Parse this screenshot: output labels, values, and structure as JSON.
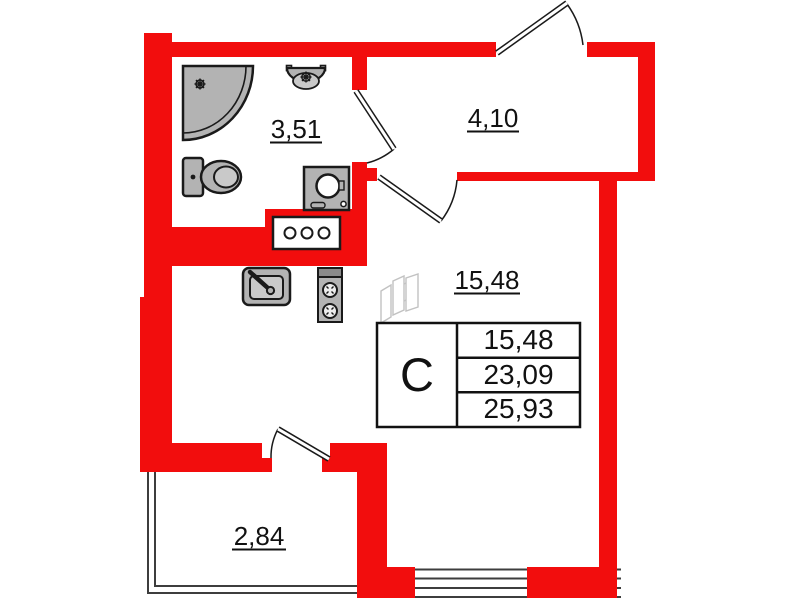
{
  "plan_labels": {
    "bathroom_area": "3,51",
    "hallway_area": "4,10",
    "living_room_area": "15,48",
    "balcony_area": "2,84"
  },
  "summary_table": {
    "unit_type": "С",
    "rows": [
      "15,48",
      "23,09",
      "25,93"
    ]
  },
  "colors": {
    "wall": "#f20d0d",
    "fixture_fill": "#b3b3b3",
    "outline": "#1a1a1a",
    "glazing_line": "#3d3d3d"
  },
  "icons": {
    "shower": "shower-icon",
    "washbasin": "washbasin-icon",
    "toilet": "toilet-icon",
    "washing_machine": "washing-machine-icon",
    "vent_shaft": "vent-shaft-icon",
    "kitchen_sink": "kitchen-sink-icon",
    "stove": "stove-icon",
    "furniture_sketch": "furniture-sketch-icon"
  }
}
